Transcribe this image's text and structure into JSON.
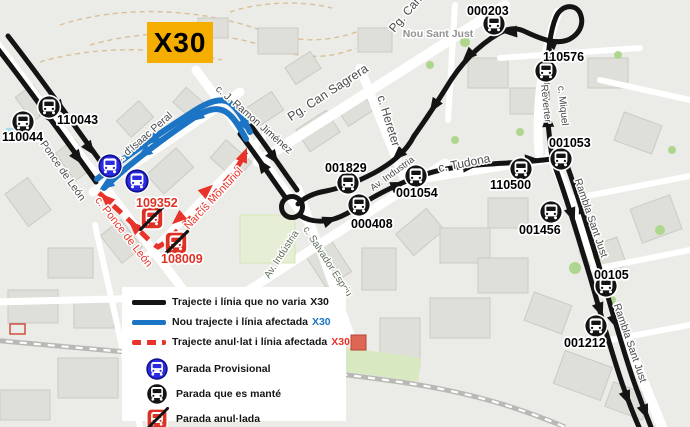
{
  "badge": {
    "label": "X30",
    "bg": "#F5AD00"
  },
  "colors": {
    "route_unchanged": "#141414",
    "route_new": "#1B74C4",
    "route_cancelled": "#E8332A",
    "stop_kept": "#141414",
    "stop_provisional": "#2B2BE2",
    "stop_provisional_ring": "#10108E",
    "stop_cancelled": "#DE3126",
    "street_label": "#4A4A4A",
    "street_label_minor": "#5F6F5A",
    "place_label": "#919191"
  },
  "legend": {
    "items": [
      {
        "kind": "line",
        "style": "solid",
        "color": "#141414",
        "text": "Trajecte i línia que no varia",
        "tag": "X30",
        "tag_color": "#141414"
      },
      {
        "kind": "line",
        "style": "solid",
        "color": "#1B74C4",
        "text": "Nou trajecte i línia afectada",
        "tag": "X30",
        "tag_color": "#1B74C4"
      },
      {
        "kind": "line",
        "style": "dashed",
        "color": "#E8332A",
        "text": "Trajecte anul·lat i línia afectada",
        "tag": "X30",
        "tag_color": "#E8332A"
      },
      {
        "kind": "stop",
        "stop": "provisional",
        "text": "Parada Provisional"
      },
      {
        "kind": "stop",
        "stop": "kept",
        "text": "Parada que es manté"
      },
      {
        "kind": "stop",
        "stop": "cancelled",
        "text": "Parada anul·lada"
      }
    ]
  },
  "map": {
    "stops": [
      {
        "id": "110043",
        "type": "kept",
        "x": 49,
        "y": 107,
        "lx": 57,
        "ly": 124,
        "anchor": "start"
      },
      {
        "id": "110044",
        "type": "kept",
        "x": 23,
        "y": 122,
        "lx": 2,
        "ly": 141,
        "anchor": "start"
      },
      {
        "id": "001829",
        "type": "kept",
        "x": 348,
        "y": 183,
        "lx": 325,
        "ly": 172,
        "anchor": "start"
      },
      {
        "id": "000408",
        "type": "kept",
        "x": 359,
        "y": 205,
        "lx": 351,
        "ly": 228,
        "anchor": "start"
      },
      {
        "id": "001054",
        "type": "kept",
        "x": 416,
        "y": 176,
        "lx": 396,
        "ly": 197,
        "anchor": "start"
      },
      {
        "id": "110500",
        "type": "kept",
        "x": 521,
        "y": 169,
        "lx": 490,
        "ly": 189,
        "anchor": "start"
      },
      {
        "id": "001053",
        "type": "kept",
        "x": 561,
        "y": 159,
        "lx": 549,
        "ly": 147,
        "anchor": "start"
      },
      {
        "id": "110576",
        "type": "kept",
        "x": 546,
        "y": 71,
        "lx": 543,
        "ly": 61,
        "anchor": "start"
      },
      {
        "id": "000203",
        "type": "kept",
        "x": 494,
        "y": 24,
        "lx": 467,
        "ly": 15,
        "anchor": "start"
      },
      {
        "id": "001456",
        "type": "kept",
        "x": 551,
        "y": 212,
        "lx": 519,
        "ly": 234,
        "anchor": "start"
      },
      {
        "id": "00105",
        "type": "kept",
        "x": 606,
        "y": 286,
        "lx": 594,
        "ly": 279,
        "anchor": "start"
      },
      {
        "id": "001212",
        "type": "kept",
        "x": 596,
        "y": 326,
        "lx": 564,
        "ly": 347,
        "anchor": "start"
      },
      {
        "id": "",
        "type": "provisional",
        "x": 110,
        "y": 166
      },
      {
        "id": "",
        "type": "provisional",
        "x": 137,
        "y": 181
      },
      {
        "id": "109352",
        "type": "cancelled",
        "x": 152,
        "y": 218,
        "lx": 136,
        "ly": 207,
        "anchor": "start"
      },
      {
        "id": "108009",
        "type": "cancelled",
        "x": 176,
        "y": 243,
        "lx": 161,
        "ly": 263,
        "anchor": "start"
      }
    ],
    "streets": [
      {
        "name": "c. Ponce de León",
        "x": 57,
        "y": 168,
        "rot": 55,
        "size": 10.5,
        "color": "default"
      },
      {
        "name": "c. d'Isaac Peral",
        "x": 146,
        "y": 140,
        "rot": -41,
        "size": 10.5,
        "color": "default"
      },
      {
        "name": "c. J. Ramon Jiménez",
        "x": 252,
        "y": 122,
        "rot": 41,
        "size": 10.5,
        "color": "default"
      },
      {
        "name": "Pg. Can Sagrera",
        "x": 330,
        "y": 96,
        "rot": -33,
        "size": 12.5,
        "color": "default"
      },
      {
        "name": "c. Hereter",
        "x": 385,
        "y": 122,
        "rot": 73,
        "size": 12,
        "color": "default"
      },
      {
        "name": "Av. Industria",
        "x": 394,
        "y": 176,
        "rot": -36,
        "size": 9.5,
        "color": "default"
      },
      {
        "name": "c. Tudona",
        "x": 465,
        "y": 167,
        "rot": -11,
        "size": 12,
        "color": "default"
      },
      {
        "name": "c. Miquel",
        "x": 560,
        "y": 106,
        "rot": 84,
        "size": 10,
        "color": "default"
      },
      {
        "name": "Reverter",
        "x": 543,
        "y": 104,
        "rot": 84,
        "size": 10,
        "color": "default"
      },
      {
        "name": "Rambla Sant Just",
        "x": 588,
        "y": 219,
        "rot": 71,
        "size": 10.5,
        "color": "default"
      },
      {
        "name": "Rambla Sant Just",
        "x": 627,
        "y": 344,
        "rot": 71,
        "size": 10.5,
        "color": "default"
      },
      {
        "name": "Nou Sant Just",
        "x": 438,
        "y": 37,
        "rot": 0,
        "size": 10.5,
        "color": "place"
      },
      {
        "name": "Pg. Can S",
        "x": 412,
        "y": 12,
        "rot": -50,
        "size": 12,
        "color": "default"
      },
      {
        "name": "c. Salvador Espriu",
        "x": 325,
        "y": 263,
        "rot": 57,
        "size": 10,
        "color": "minor"
      },
      {
        "name": "Av. Indústria",
        "x": 284,
        "y": 256,
        "rot": -57,
        "size": 10,
        "color": "minor"
      },
      {
        "name": "c. Ponce de León",
        "x": 121,
        "y": 234,
        "rot": 52,
        "size": 11,
        "color": "cancelled"
      },
      {
        "name": "c. Narcís Monturiol",
        "x": 212,
        "y": 205,
        "rot": -47,
        "size": 11,
        "color": "cancelled"
      }
    ]
  }
}
